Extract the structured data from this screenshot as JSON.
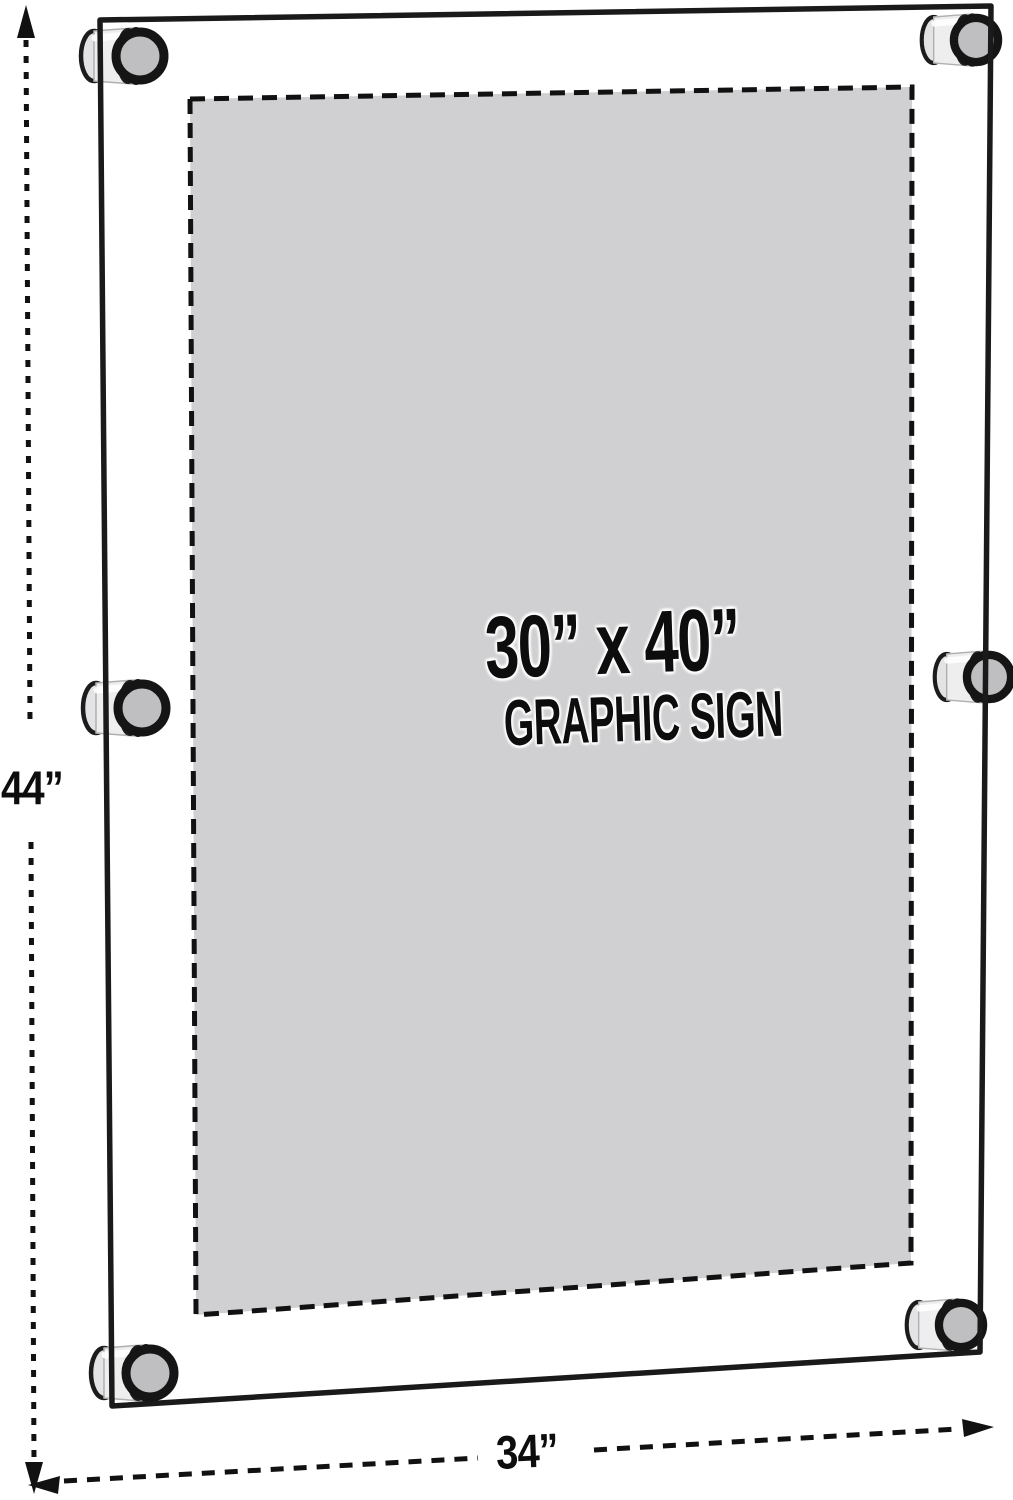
{
  "diagram": {
    "sign_area": {
      "size_label": "30” x 40”",
      "type_label": "GRAPHIC SIGN"
    },
    "dimensions": {
      "height_label": "44”",
      "width_label": "34”"
    },
    "colors": {
      "background": "#ffffff",
      "panel_stroke": "#1a1a1a",
      "graphic_fill": "#d0d0d2",
      "dashed_border": "#111111",
      "standoff_cap_fill": "#bfbfc1",
      "standoff_body_fill": "#eeeeef",
      "dimension_line": "#111111"
    }
  }
}
